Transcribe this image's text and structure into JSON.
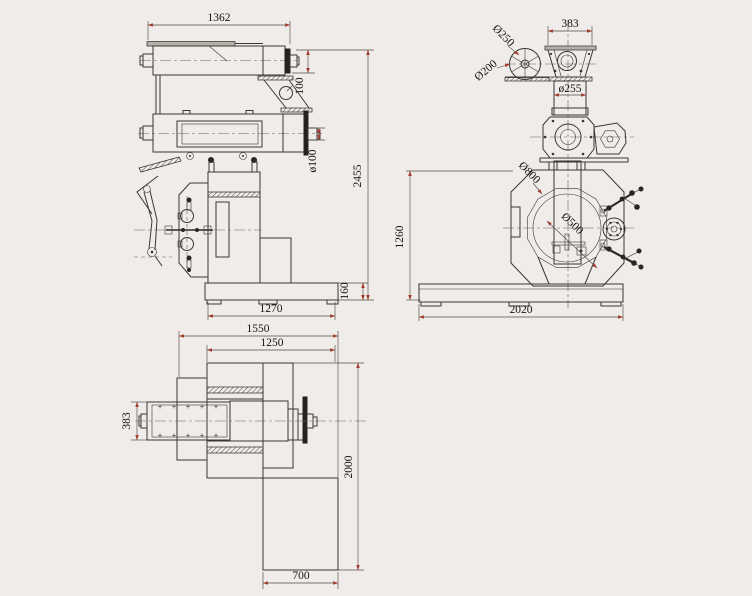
{
  "colors": {
    "background": "#efece9",
    "line": "#3b3733",
    "dimension_line": "#554b43",
    "arrow": "#a23b2e",
    "text": "#181411"
  },
  "labels": {
    "side": {
      "conveyor_length": "1362",
      "conveyor_height": "100",
      "shaft_dia": "ø100",
      "overall_height": "2455",
      "base_height": "160",
      "base_length": "1270"
    },
    "front": {
      "hopper_width": "383",
      "wheel_outer_dia": "Ø250",
      "wheel_inner_dia": "Ø200",
      "chute_dia": "ø255",
      "ring_outer_dia": "Ø800",
      "die_dia": "Ø500",
      "frame_height": "1260",
      "base_width": "2020"
    },
    "plan": {
      "overall_width": "1550",
      "body_width": "1250",
      "conditioner_width": "383",
      "overall_depth": "2000",
      "discharge_width": "700"
    }
  }
}
